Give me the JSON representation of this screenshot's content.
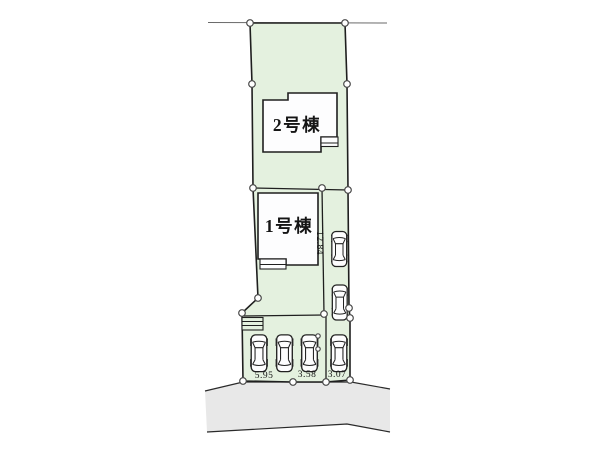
{
  "site_plan": {
    "buildings": [
      {
        "label": "2号棟"
      },
      {
        "label": "1号棟"
      }
    ],
    "dimensions": {
      "bottom": [
        "5.95",
        "3.58",
        "3.07"
      ],
      "side": "12.84"
    },
    "car_count": 6
  },
  "colors": {
    "plot_fill": "#e4f1df",
    "road_fill": "#e8e8e8",
    "outline": "#1f1f1f",
    "building_fill": "#fdfdfe",
    "thin_line": "#6a6a6a"
  }
}
